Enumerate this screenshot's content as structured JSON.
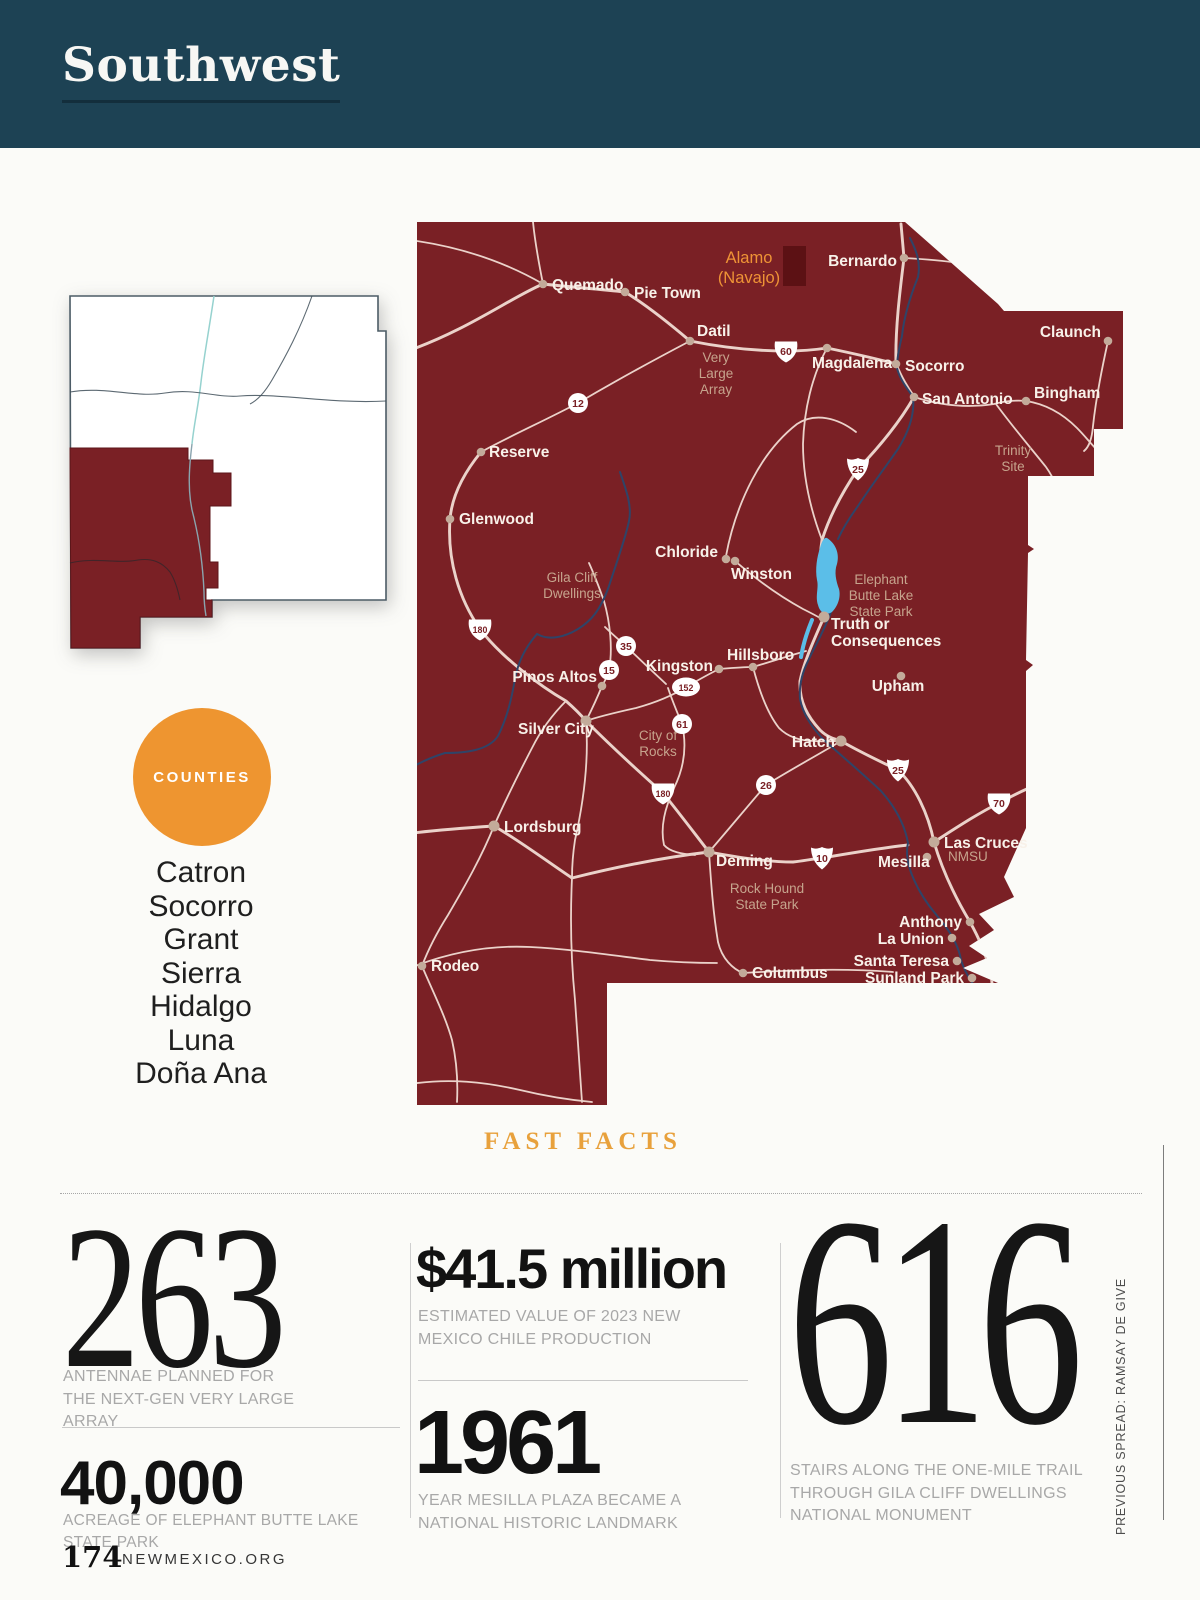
{
  "header": {
    "region_label": "Southwest"
  },
  "counties": {
    "badge": "COUNTIES",
    "list": [
      "Catron",
      "Socorro",
      "Grant",
      "Sierra",
      "Hidalgo",
      "Luna",
      "Doña Ana"
    ]
  },
  "map": {
    "colors": {
      "region": "#7A2025",
      "reservation": "#5C1114",
      "road": "#EBD2CA",
      "river": "#2F4468",
      "lake": "#5BBEE8",
      "dot": "#C3AB9A",
      "town_label": "#F8F1E9",
      "area_label": "#C6A48D",
      "alamo_label": "#EE9336"
    },
    "alamo": {
      "lines": [
        "Alamo",
        "(Navajo)"
      ],
      "x": 749,
      "y": 263,
      "lh": 20
    },
    "towns": [
      {
        "name": "Quemado",
        "lx": 552,
        "ly": 290,
        "anchor": "start",
        "dx": 543,
        "dy": 284
      },
      {
        "name": "Pie Town",
        "lx": 634,
        "ly": 298,
        "anchor": "start",
        "dx": 625,
        "dy": 292
      },
      {
        "name": "Datil",
        "lx": 697,
        "ly": 336,
        "anchor": "start",
        "dx": 690,
        "dy": 341
      },
      {
        "name": "Bernardo",
        "lx": 897,
        "ly": 266,
        "anchor": "end",
        "dx": 904,
        "dy": 258
      },
      {
        "name": "Magdalena",
        "lx": 812,
        "ly": 368,
        "anchor": "start",
        "dx": 827,
        "dy": 348
      },
      {
        "name": "Socorro",
        "lx": 905,
        "ly": 371,
        "anchor": "start",
        "dx": 896,
        "dy": 364
      },
      {
        "name": "San Antonio",
        "lx": 922,
        "ly": 404,
        "anchor": "start",
        "dx": 914,
        "dy": 397
      },
      {
        "name": "Claunch",
        "lx": 1101,
        "ly": 337,
        "anchor": "end",
        "dx": 1108,
        "dy": 341
      },
      {
        "name": "Bingham",
        "lx": 1034,
        "ly": 398,
        "anchor": "start",
        "dx": 1026,
        "dy": 401
      },
      {
        "name": "Reserve",
        "lx": 489,
        "ly": 457,
        "anchor": "start",
        "dx": 481,
        "dy": 452
      },
      {
        "name": "Glenwood",
        "lx": 459,
        "ly": 524,
        "anchor": "start",
        "dx": 450,
        "dy": 519
      },
      {
        "name": "Chloride",
        "lx": 718,
        "ly": 557,
        "anchor": "end",
        "dx": 726,
        "dy": 559
      },
      {
        "name": "Winston",
        "lx": 731,
        "ly": 579,
        "anchor": "start",
        "dx": 735,
        "dy": 561
      },
      {
        "name": "Kingston",
        "lx": 713,
        "ly": 671,
        "anchor": "end",
        "dx": 719,
        "dy": 669
      },
      {
        "name": "Hillsboro",
        "lx": 727,
        "ly": 660,
        "anchor": "start",
        "dx": 753,
        "dy": 667
      },
      {
        "name": "Pinos Altos",
        "lx": 597,
        "ly": 682,
        "anchor": "end",
        "dx": 602,
        "dy": 686
      },
      {
        "name": "Silver City",
        "lx": 518,
        "ly": 734,
        "anchor": "start",
        "dx": 586,
        "dy": 721,
        "r": 5.5
      },
      {
        "name": "Truth or|Consequences",
        "lx": 831,
        "ly": 629,
        "anchor": "start",
        "dx": 824,
        "dy": 617,
        "r": 5.5,
        "lh": 17
      },
      {
        "name": "Upham",
        "lx": 898,
        "ly": 691,
        "anchor": "middle",
        "dx": 901,
        "dy": 676
      },
      {
        "name": "Hatch",
        "lx": 835,
        "ly": 747,
        "anchor": "end",
        "dx": 841,
        "dy": 741,
        "r": 5.5
      },
      {
        "name": "Lordsburg",
        "lx": 504,
        "ly": 832,
        "anchor": "start",
        "dx": 494,
        "dy": 826,
        "r": 5.5
      },
      {
        "name": "Deming",
        "lx": 716,
        "ly": 866,
        "anchor": "start",
        "dx": 709,
        "dy": 852,
        "r": 5.5
      },
      {
        "name": "Rodeo",
        "lx": 431,
        "ly": 971,
        "anchor": "start",
        "dx": 422,
        "dy": 966
      },
      {
        "name": "Columbus",
        "lx": 752,
        "ly": 978,
        "anchor": "start",
        "dx": 743,
        "dy": 973
      },
      {
        "name": "Las Cruces",
        "lx": 944,
        "ly": 848,
        "anchor": "start",
        "dx": 934,
        "dy": 842,
        "r": 5.5
      },
      {
        "name": "Mesilla",
        "lx": 878,
        "ly": 867,
        "anchor": "start",
        "dx": 927,
        "dy": 857
      },
      {
        "name": "Anthony",
        "lx": 962,
        "ly": 927,
        "anchor": "end",
        "dx": 970,
        "dy": 922
      },
      {
        "name": "La Union",
        "lx": 944,
        "ly": 944,
        "anchor": "end",
        "dx": 952,
        "dy": 938
      },
      {
        "name": "Santa Teresa",
        "lx": 949,
        "ly": 966,
        "anchor": "end",
        "dx": 957,
        "dy": 961
      },
      {
        "name": "Sunland Park",
        "lx": 964,
        "ly": 983,
        "anchor": "end",
        "dx": 972,
        "dy": 978
      }
    ],
    "areas": [
      {
        "lines": [
          "Very",
          "Large",
          "Array"
        ],
        "x": 716,
        "y": 362,
        "lh": 16
      },
      {
        "lines": [
          "Trinity",
          "Site"
        ],
        "x": 1013,
        "y": 455,
        "lh": 16
      },
      {
        "lines": [
          "Gila Cliff",
          "Dwellings"
        ],
        "x": 572,
        "y": 582,
        "lh": 16
      },
      {
        "lines": [
          "Elephant",
          "Butte Lake",
          "State Park"
        ],
        "x": 881,
        "y": 584,
        "lh": 16
      },
      {
        "lines": [
          "City of",
          "Rocks"
        ],
        "x": 658,
        "y": 740,
        "lh": 16
      },
      {
        "lines": [
          "Rock Hound",
          "State Park"
        ],
        "x": 767,
        "y": 893,
        "lh": 16
      },
      {
        "lines": [
          "NMSU"
        ],
        "x": 948,
        "y": 861,
        "lh": 14,
        "anchor": "start",
        "size": 12.5
      }
    ],
    "shields": [
      {
        "t": "us",
        "n": "60",
        "x": 786,
        "y": 351
      },
      {
        "t": "c",
        "n": "12",
        "x": 578,
        "y": 403
      },
      {
        "t": "i",
        "n": "25",
        "x": 858,
        "y": 469
      },
      {
        "t": "us",
        "n": "180",
        "x": 480,
        "y": 629
      },
      {
        "t": "c",
        "n": "35",
        "x": 626,
        "y": 646
      },
      {
        "t": "c",
        "n": "15",
        "x": 609,
        "y": 670
      },
      {
        "t": "o",
        "n": "152",
        "x": 686,
        "y": 687
      },
      {
        "t": "c",
        "n": "61",
        "x": 682,
        "y": 724
      },
      {
        "t": "us",
        "n": "180",
        "x": 663,
        "y": 793
      },
      {
        "t": "c",
        "n": "26",
        "x": 766,
        "y": 785
      },
      {
        "t": "i",
        "n": "25",
        "x": 898,
        "y": 770
      },
      {
        "t": "us",
        "n": "70",
        "x": 999,
        "y": 803
      },
      {
        "t": "i",
        "n": "10",
        "x": 822,
        "y": 858
      }
    ]
  },
  "fast_facts": {
    "heading": "FAST FACTS",
    "facts": [
      {
        "value": "263",
        "caption": "ANTENNAE PLANNED FOR THE NEXT-GEN VERY LARGE ARRAY"
      },
      {
        "value": "40,000",
        "caption": "ACREAGE OF ELEPHANT BUTTE LAKE STATE PARK"
      },
      {
        "value": "$41.5 million",
        "caption": "ESTIMATED VALUE OF 2023 NEW MEXICO CHILE PRODUCTION"
      },
      {
        "value": "1961",
        "caption": "YEAR MESILLA PLAZA BECAME A NATIONAL HISTORIC LANDMARK"
      },
      {
        "value": "616",
        "caption": "STAIRS ALONG THE ONE-MILE TRAIL THROUGH GILA CLIFF DWELLINGS NATIONAL MONUMENT"
      }
    ]
  },
  "footer": {
    "page_number": "174",
    "site": "NEWMEXICO.ORG"
  },
  "credit": "PREVIOUS SPREAD: RAMSAY DE GIVE",
  "colors": {
    "header_navy": "#1D4254",
    "accent_orange": "#EE9530",
    "heading_gold": "#E8A13C",
    "map_red": "#7A2025",
    "caption_gray": "#A8A8A8"
  }
}
